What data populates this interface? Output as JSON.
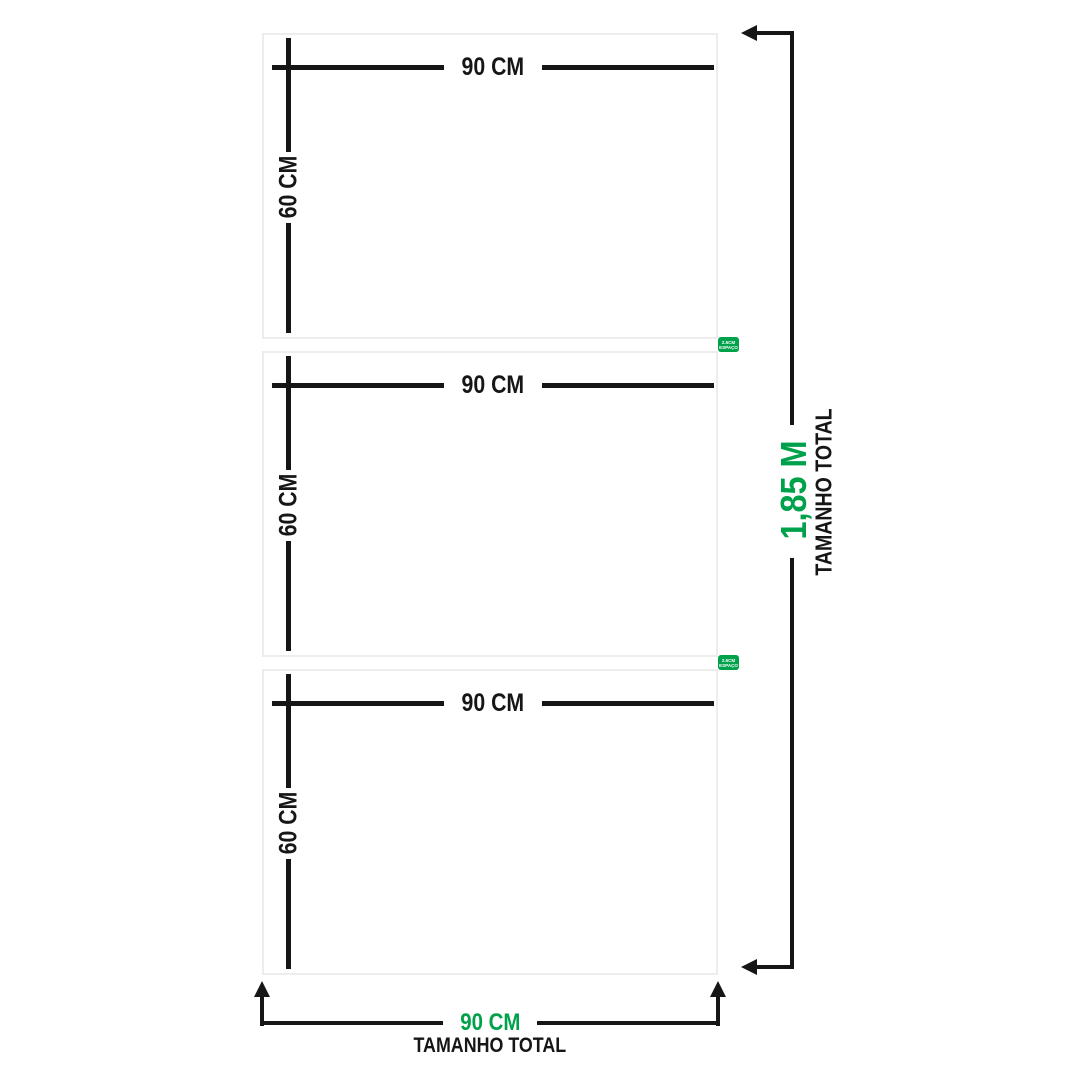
{
  "diagram": {
    "description": "3-panel wall-art size diagram",
    "panels": [
      {
        "width_label": "90 CM",
        "height_label": "60 CM"
      },
      {
        "width_label": "90 CM",
        "height_label": "60 CM"
      },
      {
        "width_label": "90 CM",
        "height_label": "60 CM"
      }
    ],
    "gap_badges": [
      {
        "line1": "2.5CM",
        "line2": "ESPAÇO"
      },
      {
        "line1": "2.5CM",
        "line2": "ESPAÇO"
      }
    ],
    "total_height": {
      "value": "1,85 M",
      "label": "TAMANHO TOTAL"
    },
    "total_width": {
      "value": "90 CM",
      "label": "TAMANHO TOTAL"
    },
    "colors": {
      "accent_green": "#00A14B",
      "line_black": "#161616",
      "panel_border": "#EDEDED",
      "background": "#FFFFFF"
    }
  }
}
